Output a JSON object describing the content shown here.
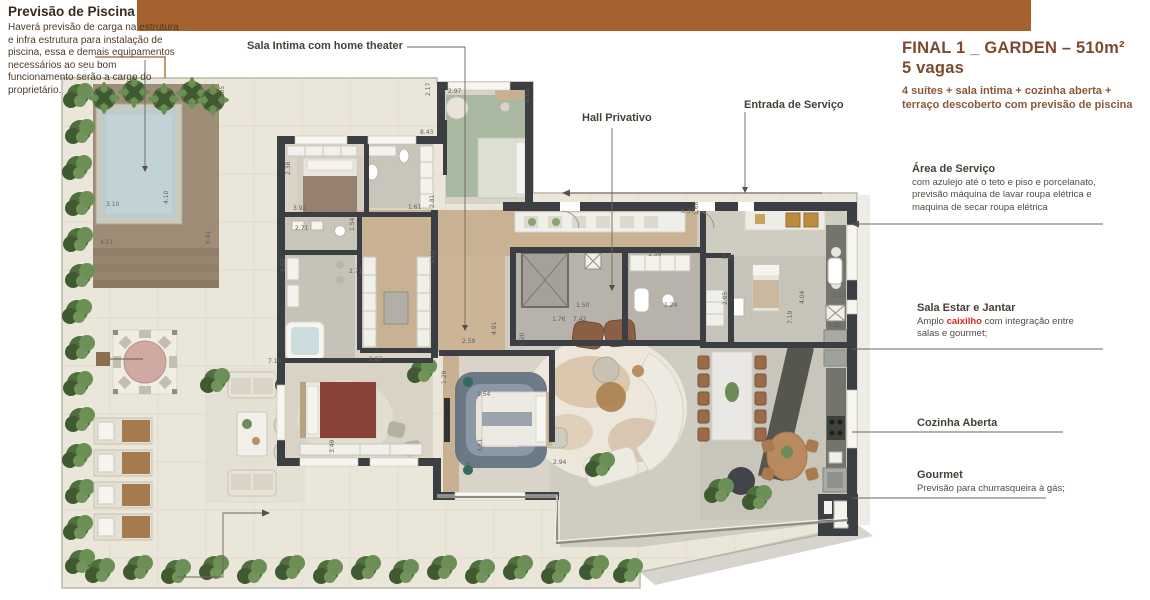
{
  "note_piscina": {
    "title": "Previsão de Piscina",
    "body": "Haverá previsão de carga na estrutura e infra estrutura para instalação de piscina, essa e demais equipamentos necessários ao seu bom funcionamento serão a cargo do proprietário."
  },
  "plan_labels": {
    "sala_intima": "Sala Intima com home theater",
    "hall_privativo": "Hall Privativo",
    "entrada_servico": "Entrada de Serviço"
  },
  "header": {
    "title_line1": "FINAL 1 _ GARDEN – 510m²",
    "title_line2": "5 vagas",
    "subtitle_line1": "4 suítes + sala intima + cozinha aberta +",
    "subtitle_line2": "terraço descoberto com previsão de piscina"
  },
  "annotations": {
    "area_servico": {
      "title": "Área de Serviço",
      "line1": "com azulejo até o teto e piso e porcelanato,",
      "line2": "previsão máquina de lavar roupa elétrica e",
      "line3": "maquina de secar roupa elétrica"
    },
    "sala_estar": {
      "title": "Sala Estar e Jantar",
      "body_prefix": "Amplo ",
      "body_highlight": "caixilho",
      "body_suffix": " com integração entre",
      "body_line2": "salas e gourmet;"
    },
    "cozinha": {
      "title": "Cozinha Aberta"
    },
    "gourmet": {
      "title": "Gourmet",
      "line1": "Previsão para churrasqueira à gás;"
    }
  },
  "colors": {
    "top_bar": "#a5622f",
    "title_brown": "#7a4a31",
    "highlight_red": "#d42a1e",
    "wall": "#3b3e42",
    "terrace": "#eae6da",
    "pool_water": "#b9cdd0",
    "deck": "#9e8d76",
    "hedge": "#55743f",
    "wood_floor": "#c9b294"
  },
  "plan": {
    "dimensions": [
      {
        "v": "18.05",
        "x": 224,
        "y": 103,
        "r": -90
      },
      {
        "v": "3.10",
        "x": 106,
        "y": 206,
        "r": 0
      },
      {
        "v": "4.10",
        "x": 168,
        "y": 204,
        "r": -90
      },
      {
        "v": "4.51",
        "x": 100,
        "y": 244,
        "r": 0
      },
      {
        "v": "6.41",
        "x": 210,
        "y": 244,
        "r": -90
      },
      {
        "v": "8.43",
        "x": 420,
        "y": 134,
        "r": 0
      },
      {
        "v": "2.17",
        "x": 430,
        "y": 96,
        "r": -90
      },
      {
        "v": "2.97",
        "x": 448,
        "y": 93,
        "r": 0
      },
      {
        "v": "6.03",
        "x": 529,
        "y": 102,
        "r": -90
      },
      {
        "v": "2.38",
        "x": 290,
        "y": 175,
        "r": -90
      },
      {
        "v": "3.92",
        "x": 293,
        "y": 210,
        "r": 0
      },
      {
        "v": "1.61",
        "x": 408,
        "y": 209,
        "r": 0
      },
      {
        "v": "2.71",
        "x": 295,
        "y": 230,
        "r": 0
      },
      {
        "v": "1.54",
        "x": 354,
        "y": 231,
        "r": -90
      },
      {
        "v": "2.71",
        "x": 349,
        "y": 273,
        "r": 0
      },
      {
        "v": "3.63",
        "x": 285,
        "y": 272,
        "r": -90
      },
      {
        "v": "2.87",
        "x": 369,
        "y": 361,
        "r": 0
      },
      {
        "v": "2.81",
        "x": 434,
        "y": 208,
        "r": -90
      },
      {
        "v": "4.02",
        "x": 435,
        "y": 263,
        "r": -90
      },
      {
        "v": "2.59",
        "x": 462,
        "y": 343,
        "r": 0
      },
      {
        "v": "1.29",
        "x": 446,
        "y": 384,
        "r": -90
      },
      {
        "v": "1.54",
        "x": 477,
        "y": 396,
        "r": 0
      },
      {
        "v": "3.49",
        "x": 334,
        "y": 453,
        "r": -90
      },
      {
        "v": "3.61",
        "x": 482,
        "y": 452,
        "r": -90
      },
      {
        "v": "3.54",
        "x": 470,
        "y": 475,
        "r": -90
      },
      {
        "v": "2.94",
        "x": 553,
        "y": 464,
        "r": 0
      },
      {
        "v": "1.50",
        "x": 576,
        "y": 307,
        "r": 0
      },
      {
        "v": "1.76",
        "x": 552,
        "y": 321,
        "r": 0
      },
      {
        "v": "7.42",
        "x": 573,
        "y": 321,
        "r": 0
      },
      {
        "v": "1.20",
        "x": 524,
        "y": 346,
        "r": -90
      },
      {
        "v": "4.91",
        "x": 496,
        "y": 335,
        "r": -90
      },
      {
        "v": "6.37",
        "x": 681,
        "y": 213,
        "r": 0
      },
      {
        "v": "1.66",
        "x": 698,
        "y": 215,
        "r": -90
      },
      {
        "v": "1.39",
        "x": 648,
        "y": 256,
        "r": 0
      },
      {
        "v": "1.24",
        "x": 664,
        "y": 307,
        "r": 0
      },
      {
        "v": "1.21",
        "x": 722,
        "y": 259,
        "r": 0
      },
      {
        "v": "2.05",
        "x": 727,
        "y": 305,
        "r": -90
      },
      {
        "v": "4.04",
        "x": 804,
        "y": 304,
        "r": -90
      },
      {
        "v": "7.19",
        "x": 792,
        "y": 324,
        "r": -90
      },
      {
        "v": "7.19",
        "x": 268,
        "y": 363,
        "r": 0
      },
      {
        "v": "2.50",
        "x": 833,
        "y": 297,
        "r": 0
      },
      {
        "v": "2.95",
        "x": 828,
        "y": 327,
        "r": 0
      }
    ]
  }
}
